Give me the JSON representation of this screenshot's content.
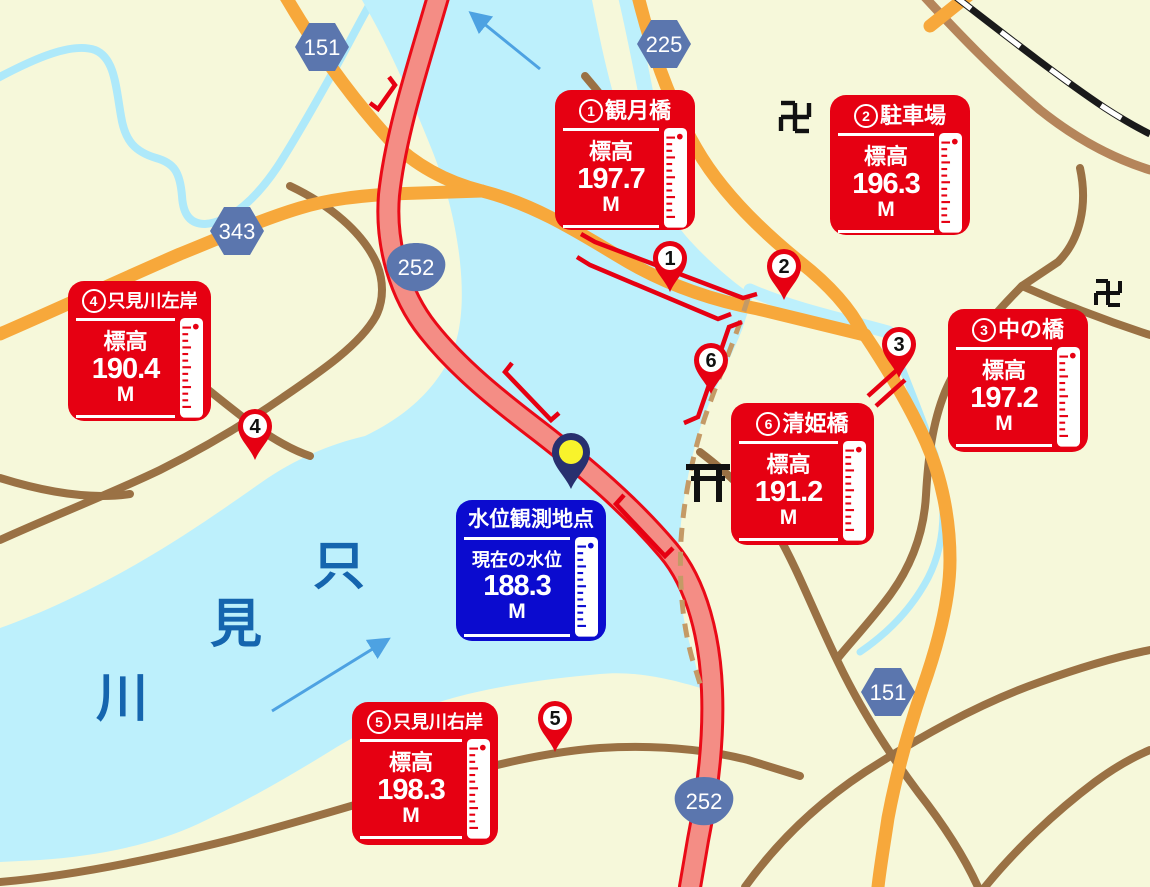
{
  "stations": [
    {
      "num": "1",
      "name": "観月橋",
      "label": "標高",
      "value": "197.7",
      "unit": "M"
    },
    {
      "num": "2",
      "name": "駐車場",
      "label": "標高",
      "value": "196.3",
      "unit": "M"
    },
    {
      "num": "3",
      "name": "中の橋",
      "label": "標高",
      "value": "197.2",
      "unit": "M"
    },
    {
      "num": "4",
      "name": "只見川左岸",
      "label": "標高",
      "value": "190.4",
      "unit": "M"
    },
    {
      "num": "5",
      "name": "只見川右岸",
      "label": "標高",
      "value": "198.3",
      "unit": "M"
    },
    {
      "num": "6",
      "name": "清姫橋",
      "label": "標高",
      "value": "191.2",
      "unit": "M"
    }
  ],
  "observation": {
    "title": "水位観測地点",
    "label": "現在の水位",
    "value": "188.3",
    "unit": "M"
  },
  "pins": [
    {
      "number": "1"
    },
    {
      "number": "2"
    },
    {
      "number": "3"
    },
    {
      "number": "4"
    },
    {
      "number": "5"
    },
    {
      "number": "6"
    }
  ],
  "shields": [
    {
      "number": "151"
    },
    {
      "number": "225"
    },
    {
      "number": "343"
    },
    {
      "number": "252"
    },
    {
      "number": "252"
    },
    {
      "number": "151"
    }
  ],
  "river": {
    "chars": [
      "只",
      "見",
      "川"
    ]
  },
  "symbols": {
    "temple": "卍"
  },
  "colors": {
    "box_red": "#e60012",
    "box_blue": "#0b0bcf",
    "water": "#bdf0fc",
    "land": "#f6f8da",
    "road_orange": "#f7a83b",
    "road_brown": "#9a7144",
    "road_tan": "#b5855b",
    "highway_pink": "#f48d85",
    "highway_red": "#ea0a17",
    "shield_blue": "#5b76ae",
    "river_text": "#1565ae",
    "arrow_blue": "#4da2e2",
    "pin_red": "#e60012",
    "obs_pin_navy": "#28306f",
    "obs_pin_yellow": "#f8f32b"
  }
}
